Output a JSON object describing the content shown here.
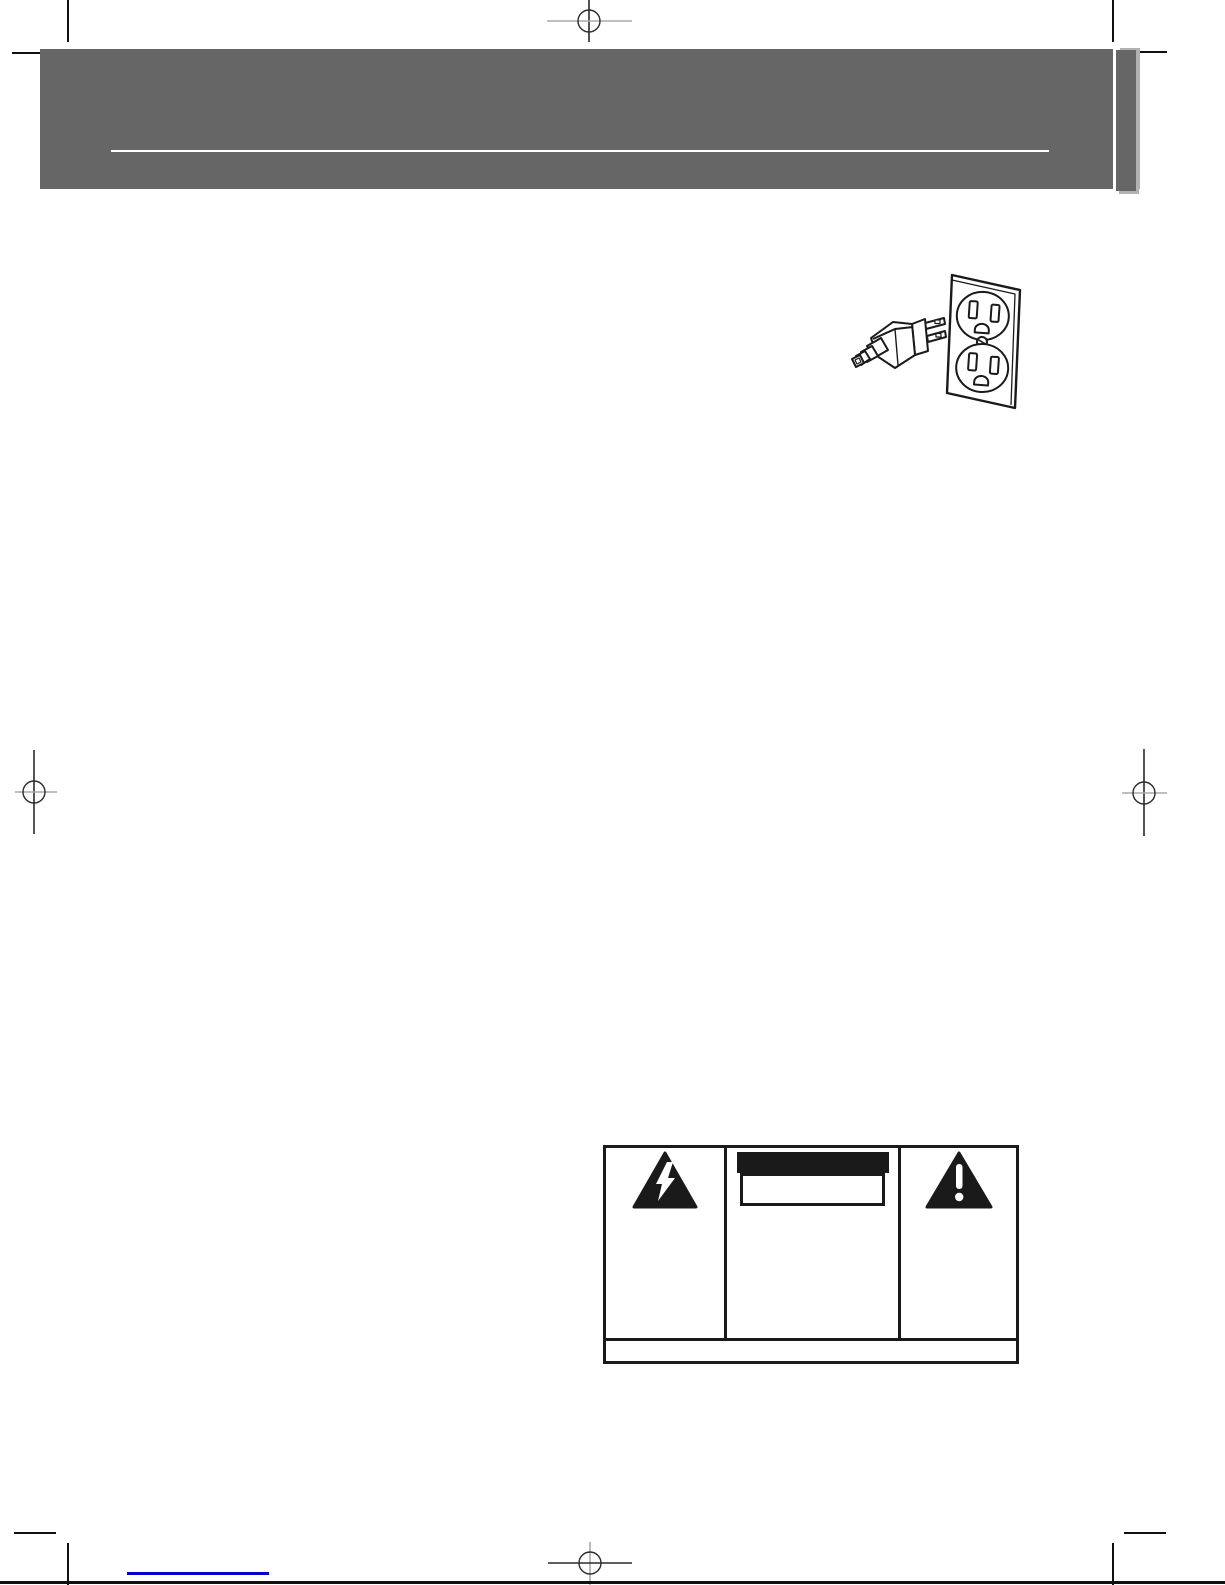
{
  "page": {
    "kind": "printed-manual-page-proof",
    "width_px": 1225,
    "height_px": 1585,
    "background_color": "#ffffff"
  },
  "colors": {
    "banner_gray": "#666666",
    "banner_rule_white": "#ffffff",
    "tab_shadow_gray": "#b2b2b2",
    "line_art_ink": "#1a1a1a",
    "trim_mark_black": "#111111",
    "registration_gray": "#aaaaaa",
    "registration_dark": "#2a2a2a",
    "link_blue": "#0000cc",
    "caution_bar_black": "#1a1a1a"
  },
  "header": {
    "banner": {
      "fill": "#666666",
      "rule_fill": "#ffffff",
      "tab_fill": "#666666",
      "text": ""
    }
  },
  "illustration": {
    "name": "power-plug-into-wall-outlet",
    "icons": [
      "power-plug-icon",
      "duplex-wall-outlet-icon"
    ],
    "ink": "#1a1a1a"
  },
  "warning_label": {
    "left_icon": "high-voltage-lightning-triangle-icon",
    "right_icon": "alert-exclamation-triangle-icon",
    "caution_bar_text": "",
    "caution_box_text": "",
    "bottom_strip_text": ""
  },
  "prepress_marks": {
    "registration_marks": [
      "registration-mark-top-center",
      "registration-mark-left-middle",
      "registration-mark-right-middle",
      "registration-mark-bottom-center"
    ],
    "crop_marks": [
      "crop-mark-top-left",
      "crop-mark-top-right",
      "crop-mark-bottom-left",
      "crop-mark-bottom-right"
    ]
  },
  "footer": {
    "link_text": "",
    "link_underline_color": "#0000cc"
  }
}
